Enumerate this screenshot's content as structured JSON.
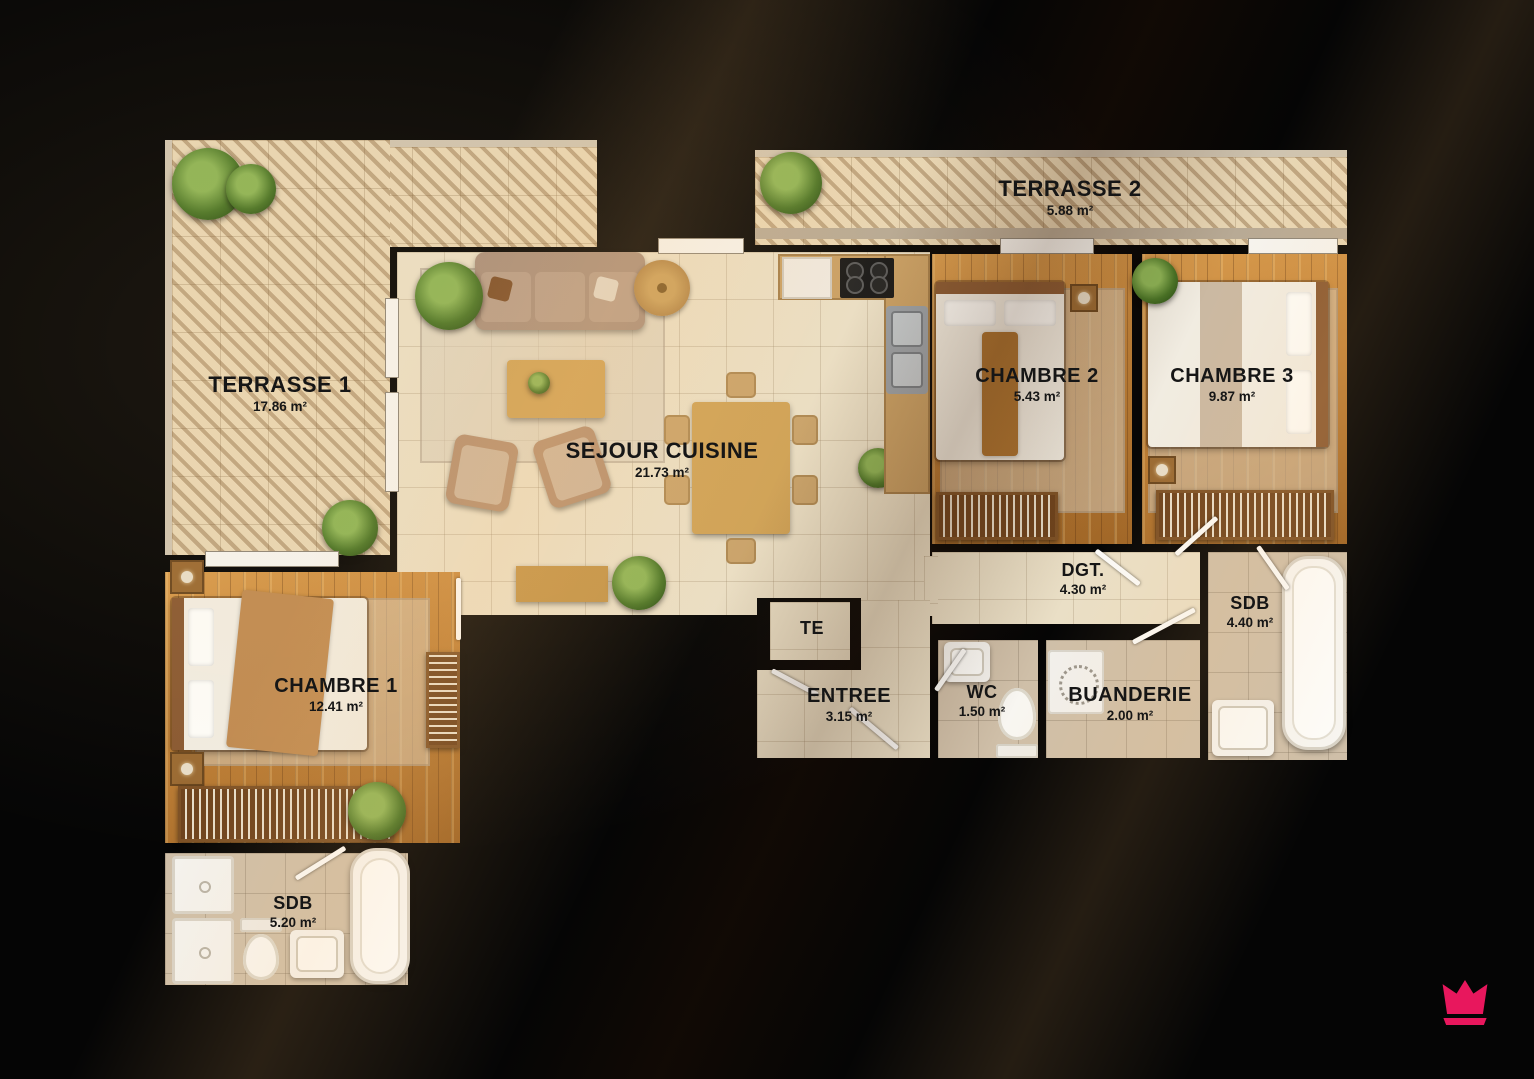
{
  "rooms": {
    "terrasse1": {
      "label": "TERRASSE 1",
      "area": "17.86 m²"
    },
    "terrasse2": {
      "label": "TERRASSE 2",
      "area": "5.88 m²"
    },
    "sejour": {
      "label": "SEJOUR CUISINE",
      "area": "21.73 m²"
    },
    "chambre1": {
      "label": "CHAMBRE 1",
      "area": "12.41 m²"
    },
    "chambre2": {
      "label": "CHAMBRE 2",
      "area": "5.43 m²"
    },
    "chambre3": {
      "label": "CHAMBRE 3",
      "area": "9.87 m²"
    },
    "dgt": {
      "label": "DGT.",
      "area": "4.30 m²"
    },
    "sdb_right": {
      "label": "SDB",
      "area": "4.40 m²"
    },
    "entree": {
      "label": "ENTREE",
      "area": "3.15 m²"
    },
    "wc": {
      "label": "WC",
      "area": "1.50 m²"
    },
    "buanderie": {
      "label": "BUANDERIE",
      "area": "2.00 m²"
    },
    "sdb_left": {
      "label": "SDB",
      "area": "5.20 m²"
    },
    "te": {
      "label": "TE"
    }
  },
  "branding": {
    "logo": "crown",
    "color": "#E8175D"
  },
  "colors": {
    "background": "#050505",
    "floor_tile": "#eadfc6",
    "floor_wood": "#c1813a",
    "label": "#161616"
  }
}
